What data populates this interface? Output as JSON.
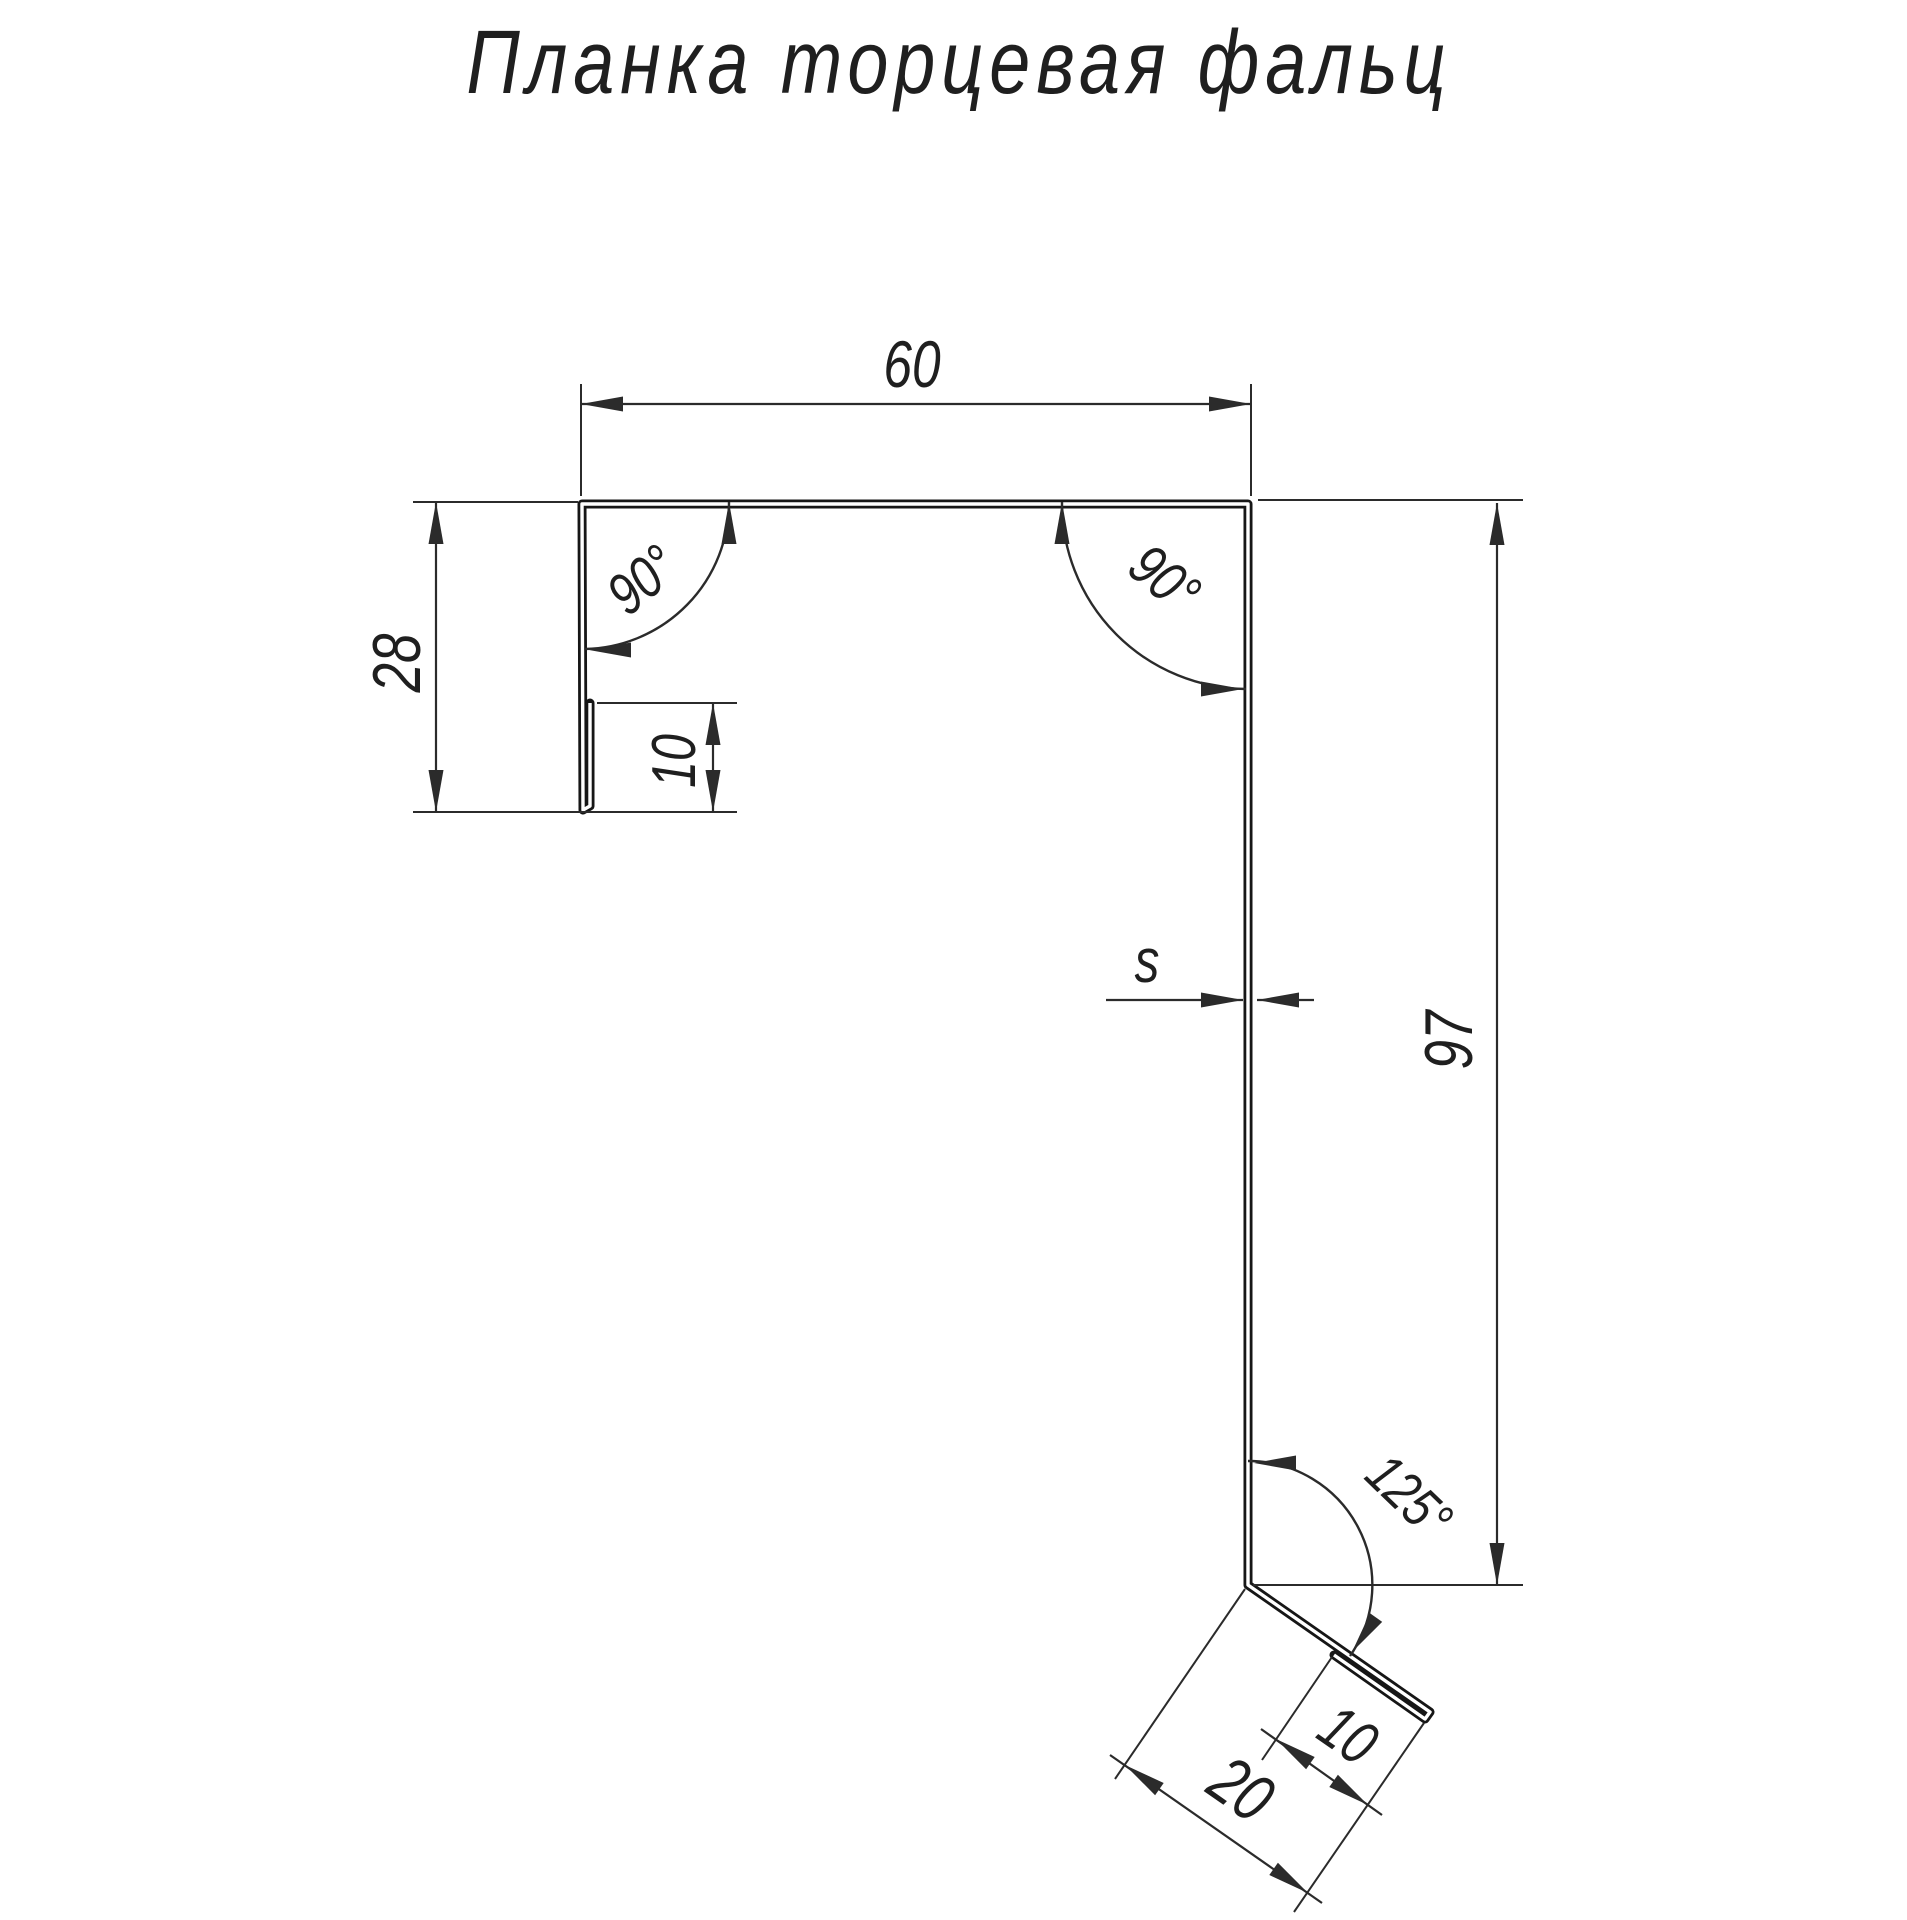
{
  "title": "Планка торцевая фальц",
  "colors": {
    "background": "#ffffff",
    "line": "#2b2b2b",
    "line_strong": "#161616",
    "text": "#1f1f1f"
  },
  "dimensions": {
    "top_width": {
      "label": "60"
    },
    "left_height": {
      "label": "28"
    },
    "left_hem": {
      "label": "10"
    },
    "right_height": {
      "label": "97"
    },
    "thickness": {
      "label": "s"
    },
    "kick_hem": {
      "label": "10"
    },
    "kick_width": {
      "label": "20"
    },
    "angle_top_left": {
      "label": "90°"
    },
    "angle_top_right": {
      "label": "90°"
    },
    "angle_bottom": {
      "label": "125°"
    }
  }
}
